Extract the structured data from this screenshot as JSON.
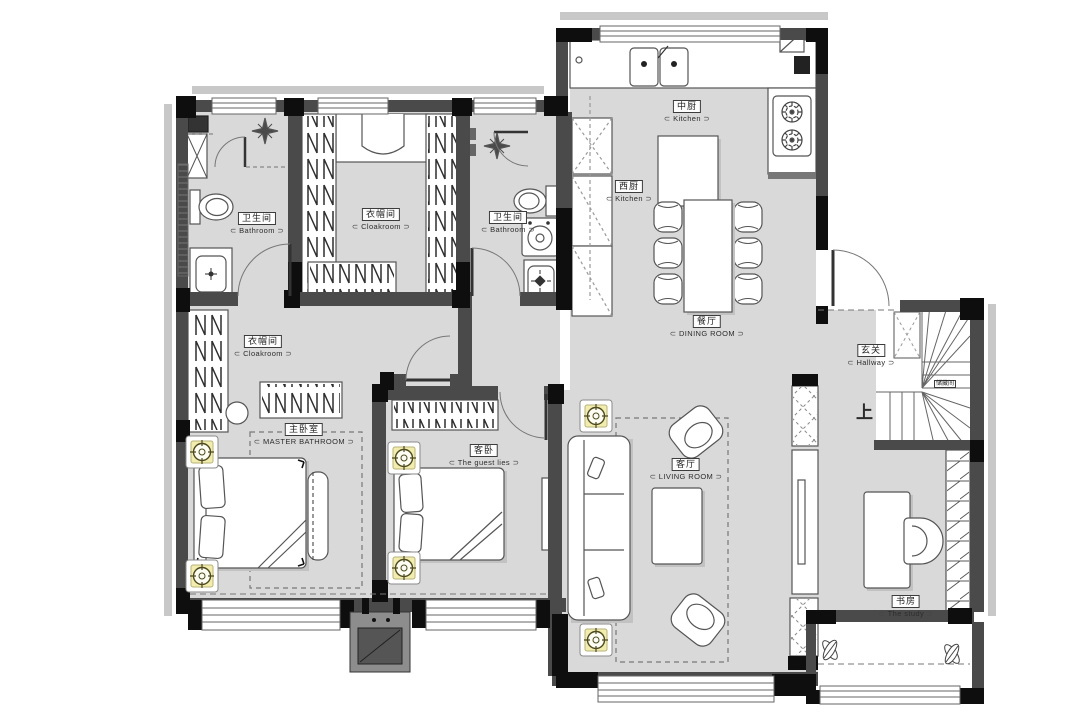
{
  "title": "residential-floor-plan",
  "colors": {
    "floor": "#d9d9d9",
    "wall": "#4a4a4a",
    "wall_dark": "#0e0e0e",
    "fixture_outline": "#555555",
    "accent_socket": "#f2edae",
    "eave": "#c8c8c8"
  },
  "rooms": {
    "bathroom1": {
      "cn": "卫生间",
      "en": "Bathroom"
    },
    "cloakroom1": {
      "cn": "衣帽间",
      "en": "Cloakroom"
    },
    "bathroom2": {
      "cn": "卫生间",
      "en": "Bathroom"
    },
    "kitchen_mid": {
      "cn": "中厨",
      "en": "Kitchen"
    },
    "kitchen_west": {
      "cn": "西厨",
      "en": "Kitchen"
    },
    "dining": {
      "cn": "餐厅",
      "en": "DINING ROOM"
    },
    "hallway": {
      "cn": "玄关",
      "en": "Hallway"
    },
    "storage": {
      "cn": "储藏间"
    },
    "cloakroom2": {
      "cn": "衣帽间",
      "en": "Cloakroom"
    },
    "master": {
      "cn": "主卧室",
      "en": "MASTER BATHROOM"
    },
    "guest": {
      "cn": "客卧",
      "en": "The guest lies"
    },
    "living": {
      "cn": "客厅",
      "en": "LIVING ROOM"
    },
    "study": {
      "cn": "书房",
      "en": "The study"
    }
  },
  "stairs": {
    "up": "上"
  }
}
